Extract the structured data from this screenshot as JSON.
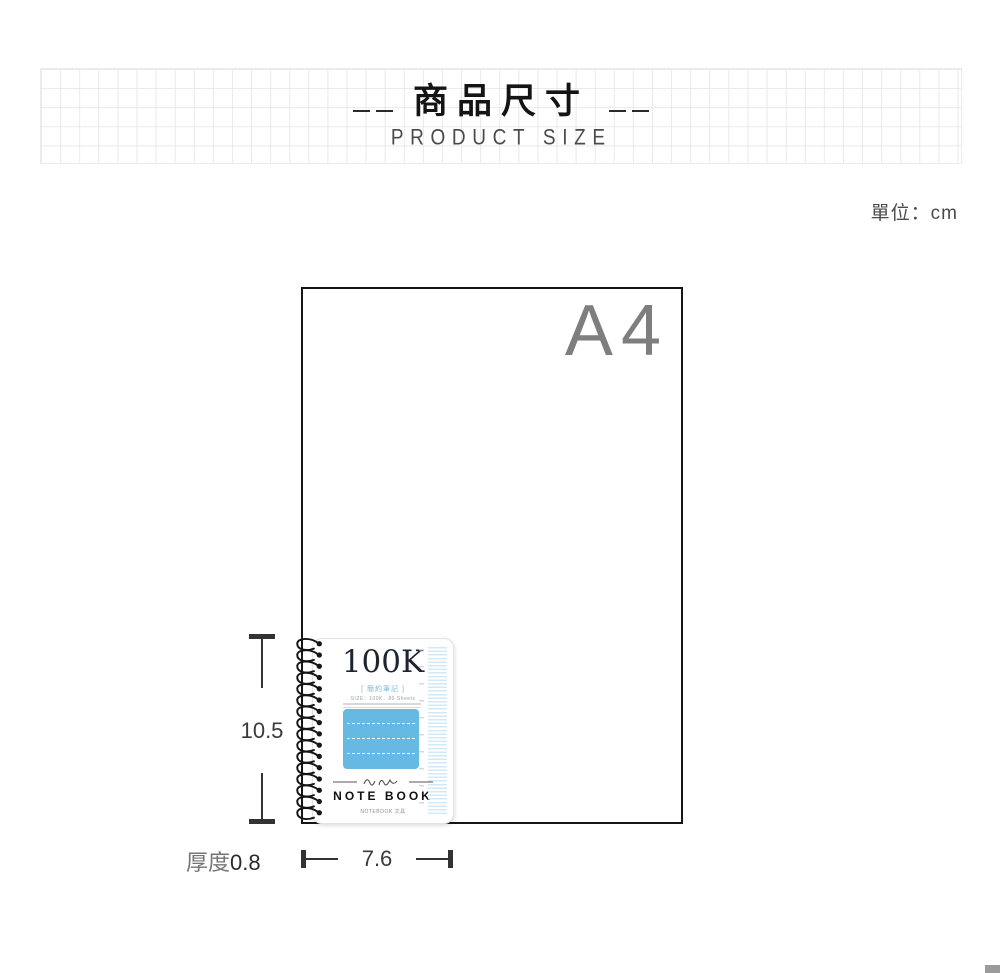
{
  "header": {
    "title": "商品尺寸",
    "subtitle": "PRODUCT SIZE"
  },
  "unit_label": "單位：cm",
  "diagram": {
    "paper_label": "A4",
    "height_value": "10.5",
    "width_value": "7.6",
    "thickness_label": "厚度",
    "thickness_value": "0.8"
  },
  "notebook": {
    "cover_title": "100K",
    "cover_subtitle": "[ 簡約筆記 ]",
    "spec_line": "SIZE：100K．80 Sheets",
    "product_name": "NOTE BOOK",
    "brand_line": "NOTEBOOK 文具"
  },
  "colors": {
    "accent_blue": "#66b9e3",
    "ruler_blue": "#d2eaf6",
    "paper_label_gray": "#7e7e7e",
    "dimension_dark": "#333333"
  }
}
